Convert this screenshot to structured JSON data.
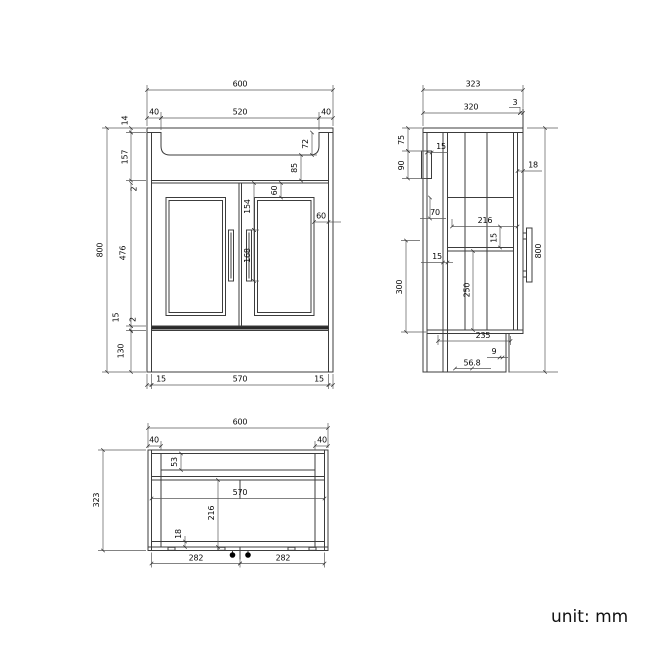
{
  "drawing": {
    "front": {
      "overall_width": "600",
      "left_overhang": "40",
      "basin_width": "520",
      "right_overhang": "40",
      "top_thickness": "14",
      "upper_section_height": "157",
      "top_gap": "2",
      "door_height": "476",
      "bottom_inset": "15",
      "bottom_gap": "2",
      "plinth_height": "130",
      "overall_height": "800",
      "basin_depth": "72",
      "basin_to_doors": "85",
      "panel_top_offset": "60",
      "handle_top_offset": "154",
      "handle_length": "168",
      "panel_side_offset": "60",
      "base_left_inset": "15",
      "base_inner_width": "570",
      "base_right_inset": "15"
    },
    "side": {
      "overall_depth": "323",
      "top_depth": "320",
      "front_gap": "3",
      "bracket_top_offset": "75",
      "bracket_height": "90",
      "bracket_thickness": "15",
      "door_thickness": "18",
      "drawer_offset": "70",
      "inner_depth": "216",
      "shelf_gap": "15",
      "back_panel_thickness": "15",
      "lower_section_height": "300",
      "shelf_clearance": "250",
      "overall_height": "800",
      "plinth_depth": "235",
      "plinth_thickness": "9",
      "plinth_recess": "56.8"
    },
    "plan": {
      "overall_width": "600",
      "left_overhang": "40",
      "right_overhang": "40",
      "overall_depth": "323",
      "front_rail": "53",
      "inner_width": "570",
      "inner_depth": "216",
      "back_rail": "18",
      "fixing_spacing_left": "282",
      "fixing_spacing_right": "282"
    },
    "note": "unit: mm"
  }
}
